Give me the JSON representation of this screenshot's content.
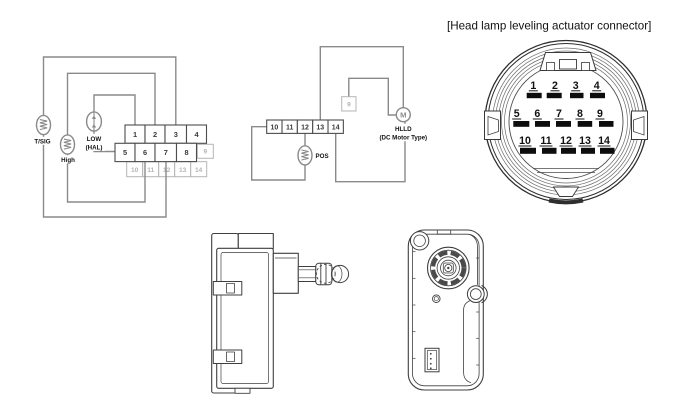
{
  "connector_title": "[Head lamp leveling actuator connector]",
  "colors": {
    "wire_gray": "#8a8a8a",
    "inactive_gray": "#b5b5b5",
    "line_dark": "#3f3f3f",
    "pin_slot_black": "#0d0d0d",
    "background": "#ffffff"
  },
  "wiring_left": {
    "bulb_tsig": "T/SIG",
    "bulb_high": "High",
    "bulb_low_line1": "LOW",
    "bulb_low_line2": "(HAL)",
    "pins_row1": [
      "1",
      "2",
      "3",
      "4"
    ],
    "pins_row2": [
      "5",
      "6",
      "7",
      "8"
    ],
    "pin_9": "9",
    "pins_row3": [
      "10",
      "11",
      "12",
      "13",
      "14"
    ]
  },
  "wiring_middle": {
    "pins": [
      "10",
      "11",
      "12",
      "13",
      "14"
    ],
    "pin_9": "9",
    "motor_symbol": "M",
    "motor_label": "HLLD",
    "motor_sublabel": "(DC Motor Type)",
    "bulb_pos": "POS"
  },
  "connector_face": {
    "row1": [
      "1",
      "2",
      "3",
      "4"
    ],
    "row2": [
      "5",
      "6",
      "7",
      "8",
      "9"
    ],
    "row3": [
      "10",
      "11",
      "12",
      "13",
      "14"
    ]
  }
}
